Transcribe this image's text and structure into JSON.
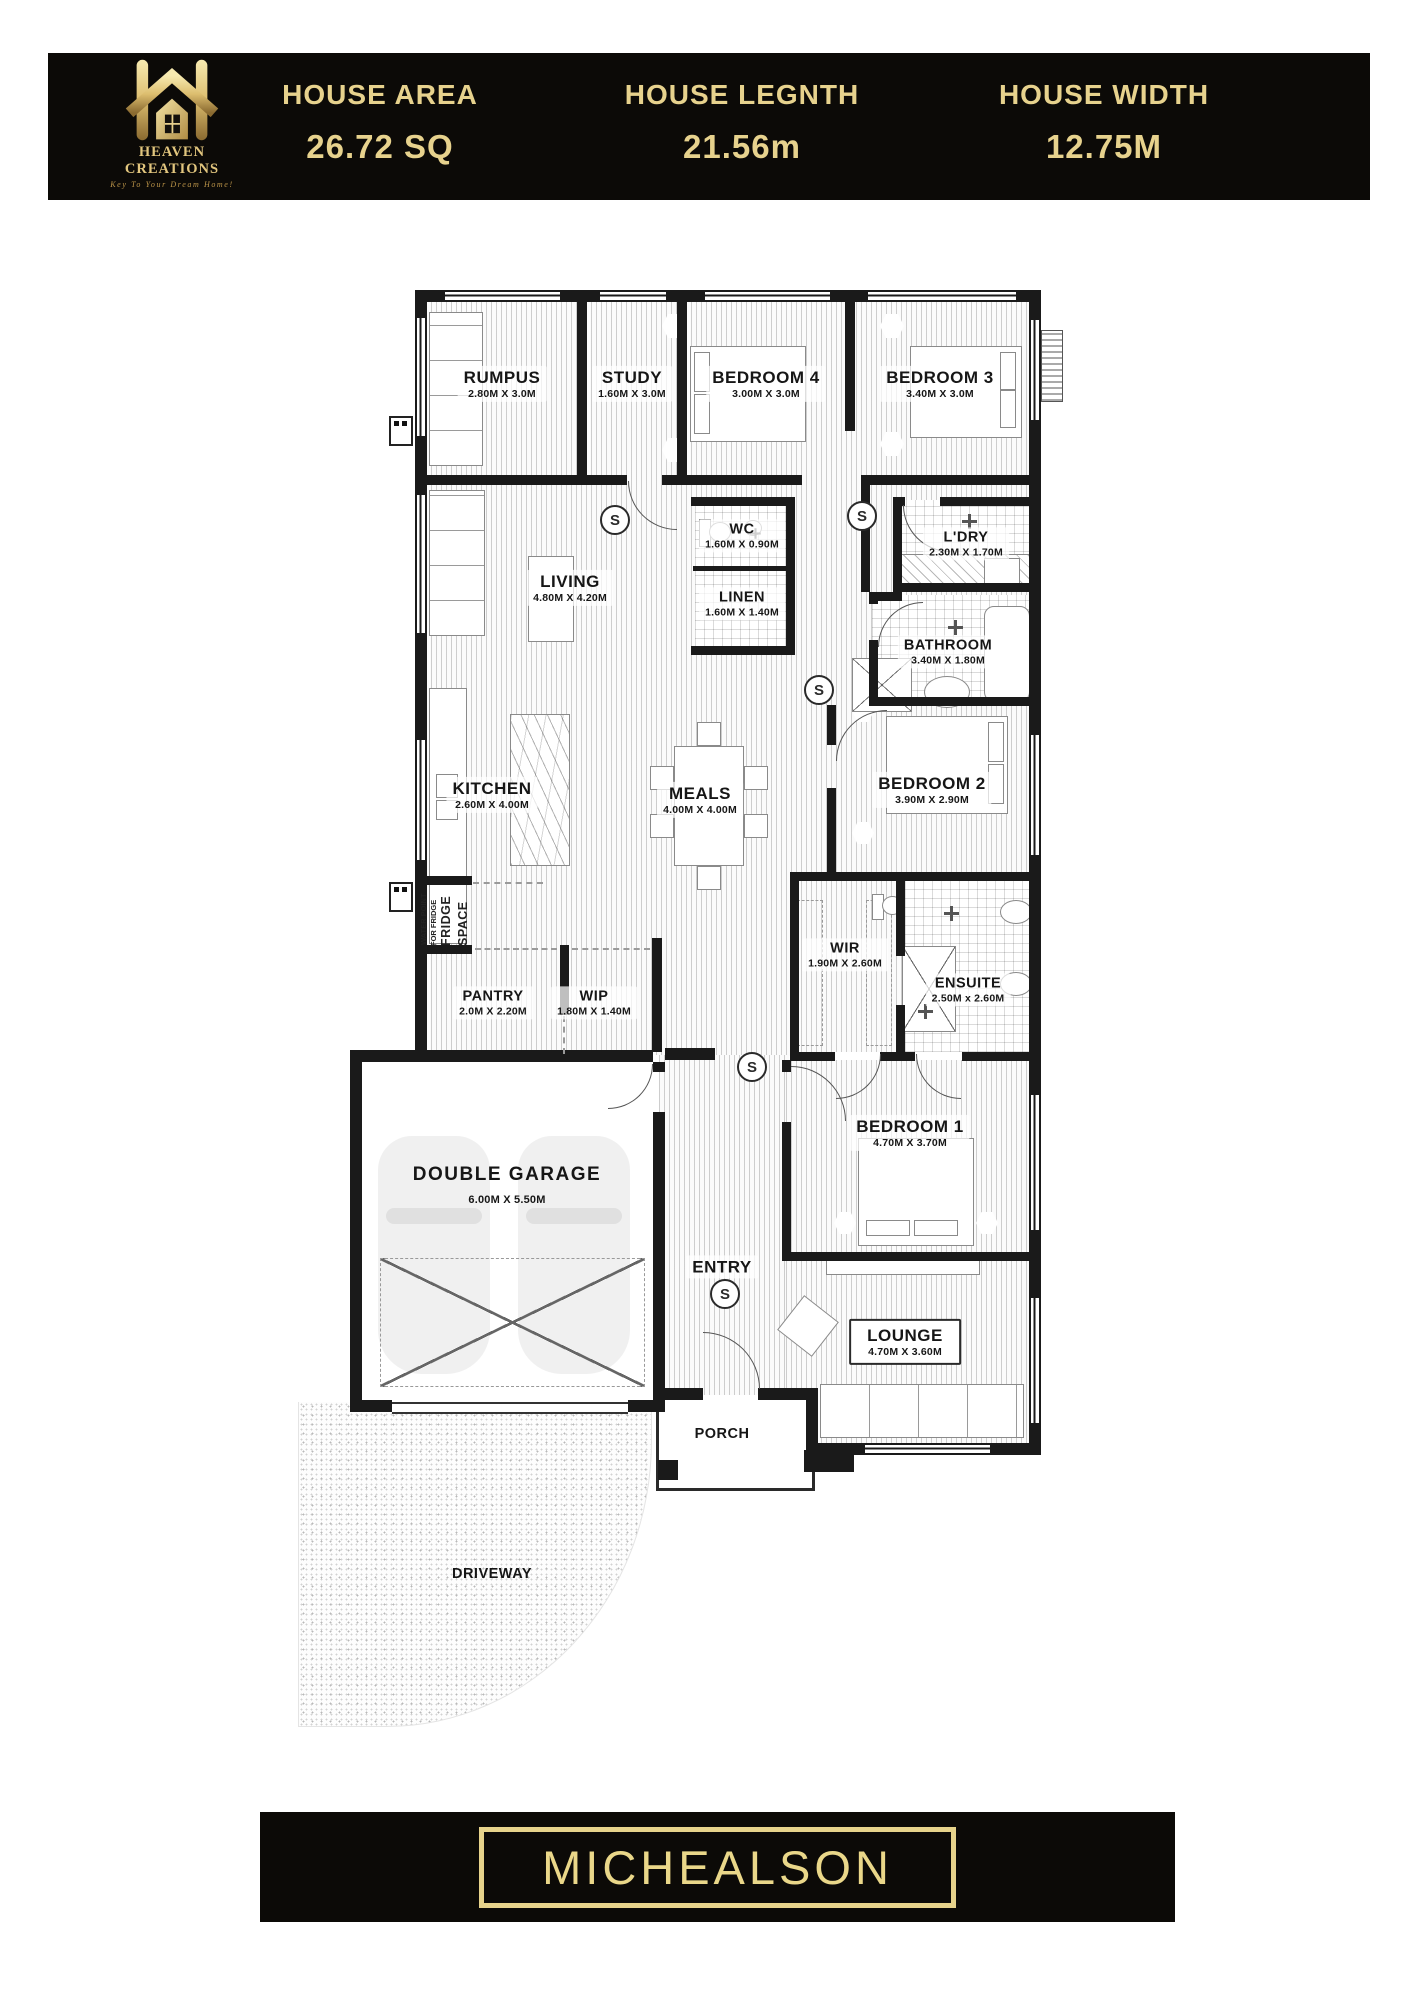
{
  "header": {
    "stats": [
      {
        "label": "HOUSE AREA",
        "value": "26.72 SQ"
      },
      {
        "label": "HOUSE LEGNTH",
        "value": "21.56m"
      },
      {
        "label": "HOUSE WIDTH",
        "value": "12.75M"
      }
    ]
  },
  "logo": {
    "name": "HEAVEN CREATIONS",
    "tagline": "Key To Your Dream Home!"
  },
  "plan": {
    "smoke_label": "S",
    "annotations": {
      "water_point_line1": "WATER POINT",
      "water_point_line2": "FOR FRIDGE",
      "fridge": "FRIDGE",
      "space": "SPACE"
    },
    "rooms": [
      {
        "name": "RUMPUS",
        "dims": "2.80M X 3.0M"
      },
      {
        "name": "STUDY",
        "dims": "1.60M X 3.0M"
      },
      {
        "name": "BEDROOM 4",
        "dims": "3.00M X 3.0M"
      },
      {
        "name": "BEDROOM 3",
        "dims": "3.40M X 3.0M"
      },
      {
        "name": "WC",
        "dims": "1.60M X 0.90M"
      },
      {
        "name": "LINEN",
        "dims": "1.60M X 1.40M"
      },
      {
        "name": "L'DRY",
        "dims": "2.30M X 1.70M"
      },
      {
        "name": "BATHROOM",
        "dims": "3.40M X 1.80M"
      },
      {
        "name": "LIVING",
        "dims": "4.80M X 4.20M"
      },
      {
        "name": "KITCHEN",
        "dims": "2.60M X 4.00M"
      },
      {
        "name": "MEALS",
        "dims": "4.00M X 4.00M"
      },
      {
        "name": "BEDROOM 2",
        "dims": "3.90M X 2.90M"
      },
      {
        "name": "WIR",
        "dims": "1.90M X 2.60M"
      },
      {
        "name": "ENSUITE",
        "dims": "2.50M x 2.60M"
      },
      {
        "name": "PANTRY",
        "dims": "2.0M X 2.20M"
      },
      {
        "name": "WIP",
        "dims": "1.80M X 1.40M"
      },
      {
        "name": "BEDROOM 1",
        "dims": "4.70M X 3.70M"
      },
      {
        "name": "DOUBLE GARAGE",
        "dims": "6.00M X 5.50M"
      },
      {
        "name": "ENTRY",
        "dims": ""
      },
      {
        "name": "LOUNGE",
        "dims": "4.70M X 3.60M"
      },
      {
        "name": "PORCH",
        "dims": ""
      },
      {
        "name": "DRIVEWAY",
        "dims": ""
      }
    ]
  },
  "footer": {
    "title": "MICHEALSON"
  },
  "colors": {
    "gold": "#e7d28d",
    "bar_black": "#0c0a07",
    "wall": "#1a1a1a"
  }
}
